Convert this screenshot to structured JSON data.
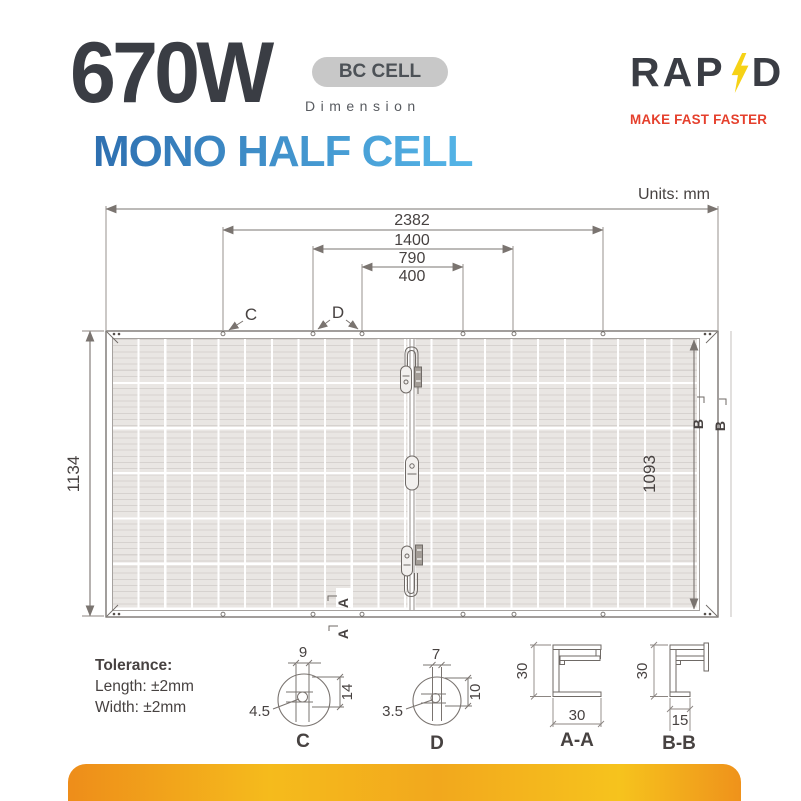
{
  "header": {
    "wattage": "670W",
    "badge": "BC CELL",
    "subtitle": "Dimension",
    "product": "MONO HALF CELL",
    "brand_rap": "RAP",
    "brand_d": "D",
    "tagline": "MAKE FAST FASTER"
  },
  "drawing": {
    "units_label": "Units: mm",
    "dims": {
      "d2382": "2382",
      "d1400": "1400",
      "d790": "790",
      "d400": "400",
      "d1134": "1134",
      "d1093": "1093"
    },
    "labels": {
      "c": "C",
      "d": "D",
      "a": "A",
      "b": "B"
    }
  },
  "tolerance": {
    "title": "Tolerance:",
    "length": "Length: ±2mm",
    "width": "Width: ±2mm"
  },
  "details": {
    "c": {
      "label": "C",
      "top": "9",
      "side": "14",
      "hole": "4.5"
    },
    "d": {
      "label": "D",
      "top": "7",
      "side": "10",
      "hole": "3.5"
    },
    "aa": {
      "label": "A-A",
      "height": "30",
      "width": "30"
    },
    "bb": {
      "label": "B-B",
      "height": "30",
      "width": "15"
    }
  },
  "colors": {
    "charcoal": "#3a3d44",
    "blue_gradient_start": "#2e6fb0",
    "blue_gradient_end": "#55b6e8",
    "badge_gray": "#c8c8c8",
    "brand_red": "#e5402d",
    "bolt_yellow": "#f6d216",
    "line_gray": "#7a7470",
    "cell_gray": "#e9e6e3",
    "accent_bar_orange": "#ee8d1a",
    "accent_bar_yellow": "#f6c31d"
  }
}
